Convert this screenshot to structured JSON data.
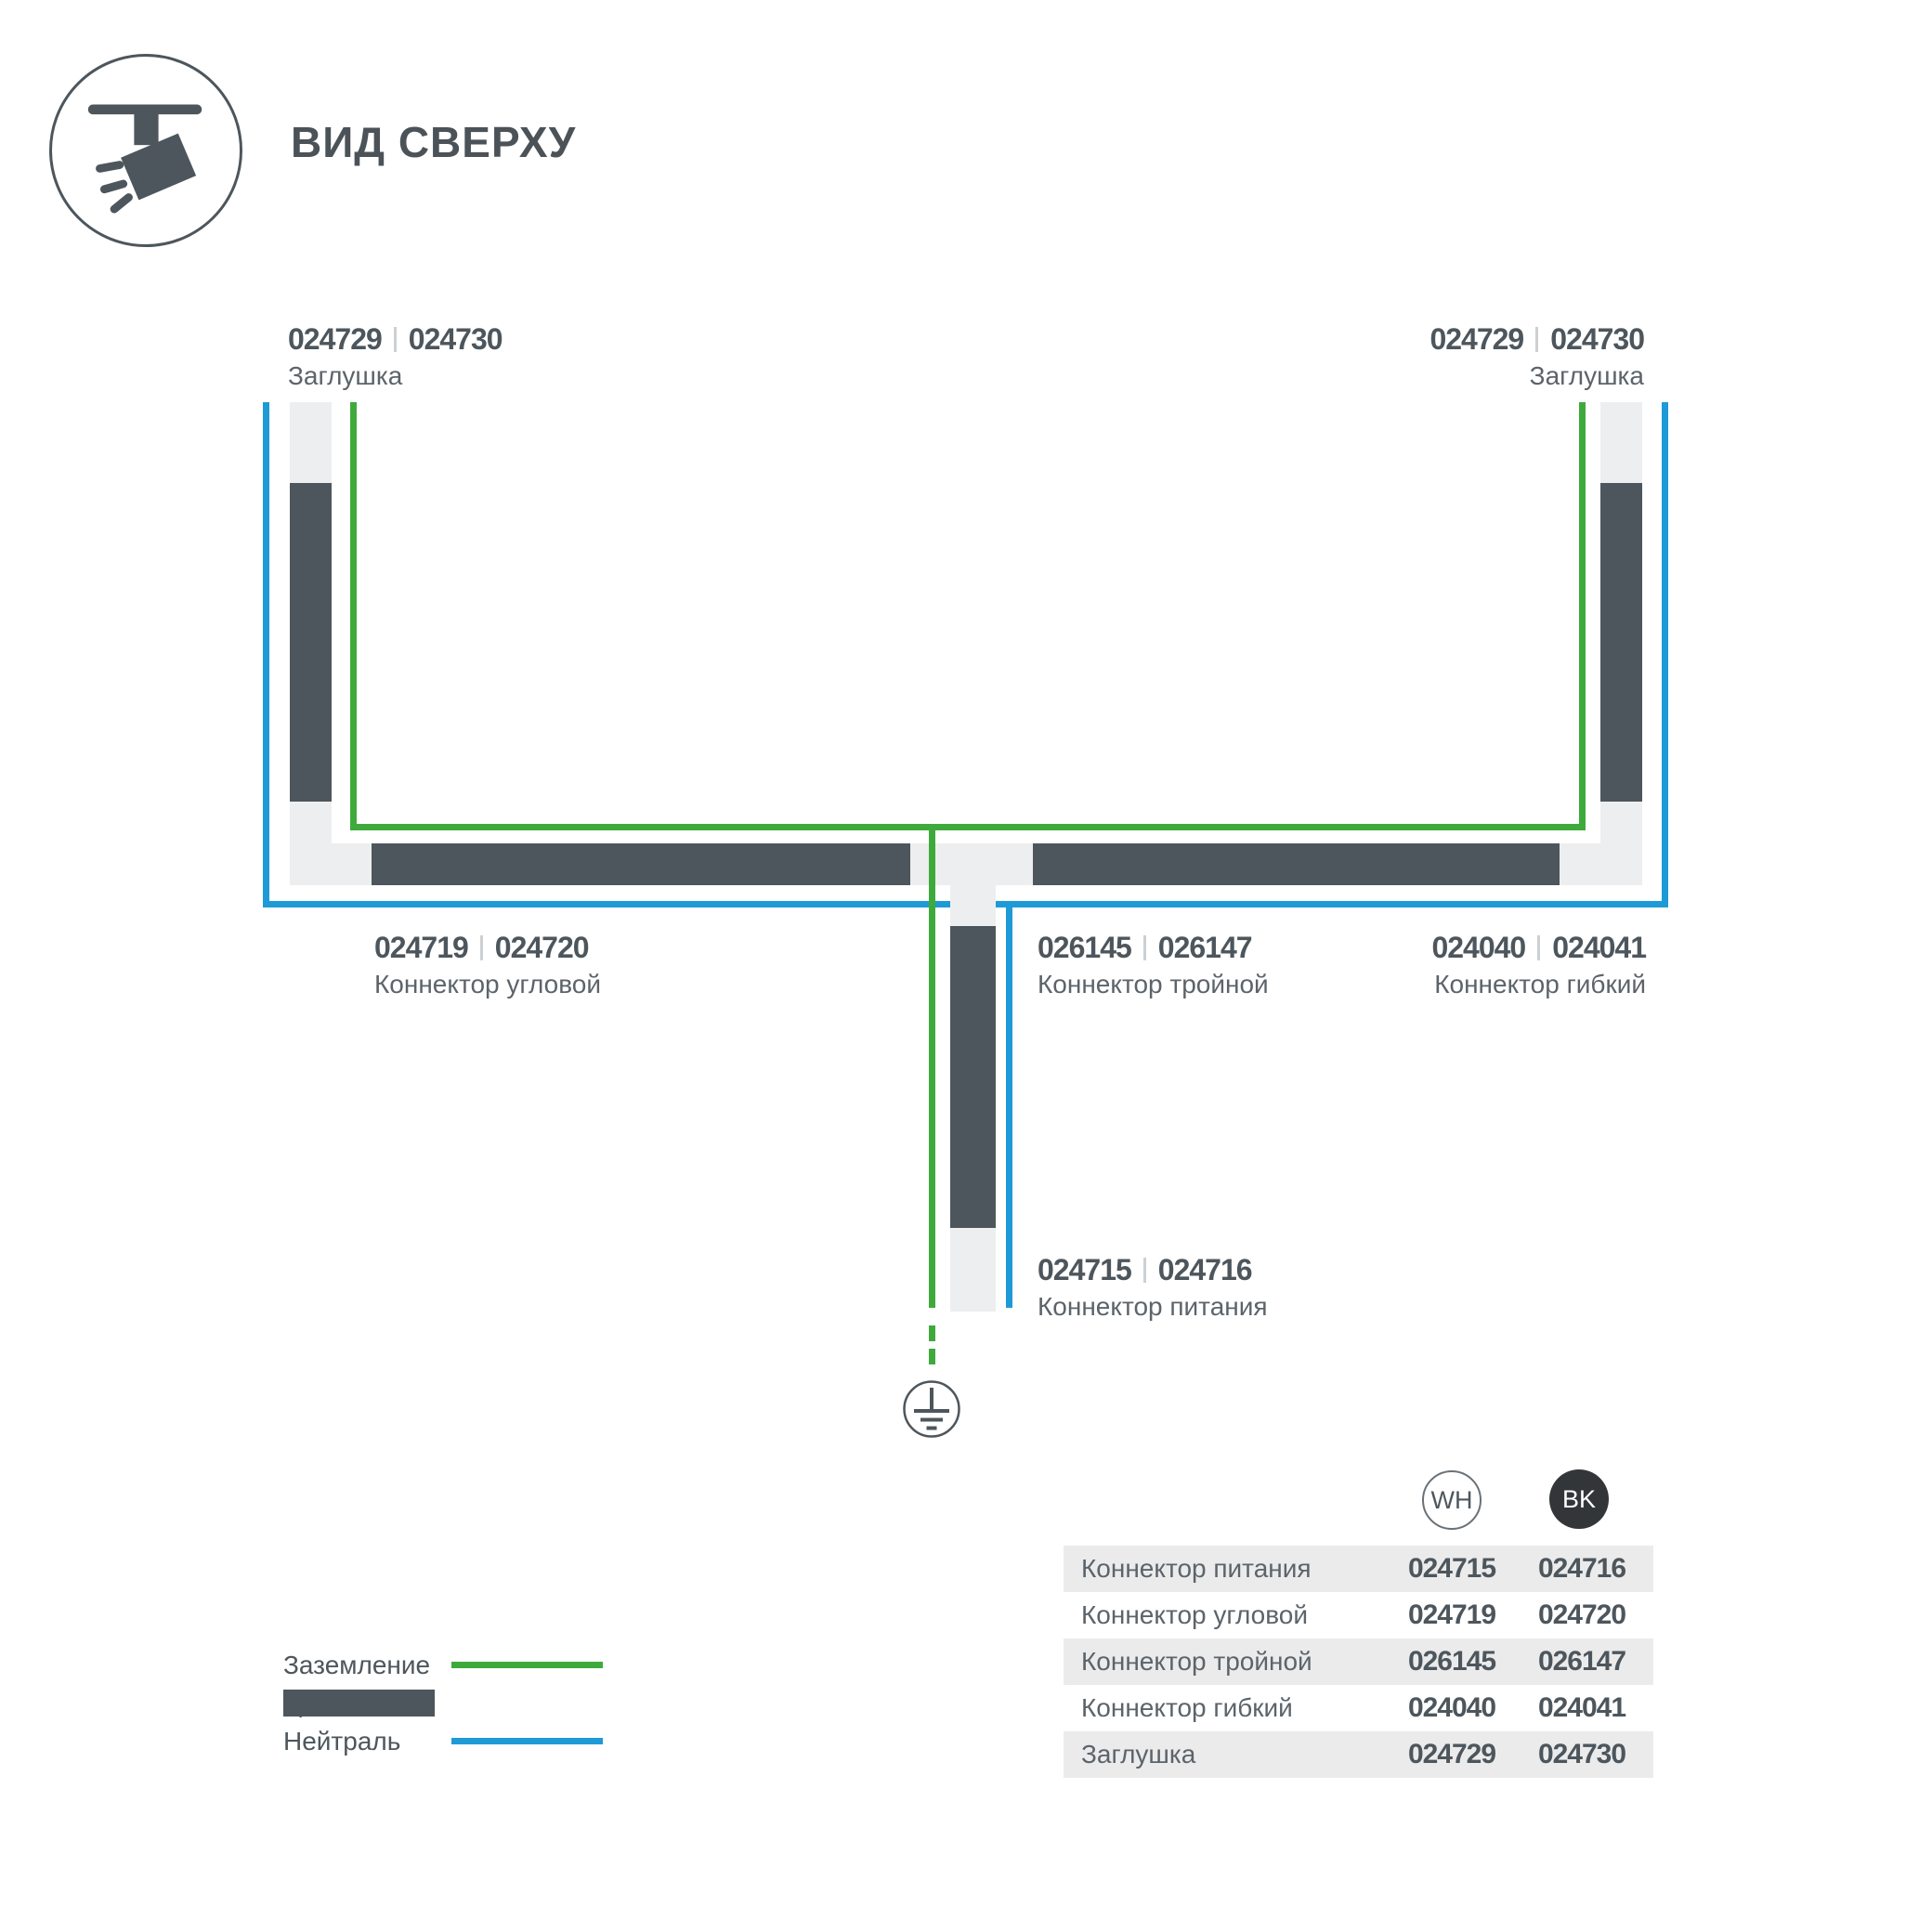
{
  "title": "ВИД СВЕРХУ",
  "colors": {
    "track": "#4d565c",
    "ground_wire": "#3faa3c",
    "neutral_wire": "#1e9ad6",
    "connector": "#edeeef",
    "bk_badge": "#323639"
  },
  "parts": {
    "cap_left": {
      "code_wh": "024729",
      "code_bk": "024730",
      "name": "Заглушка"
    },
    "cap_right": {
      "code_wh": "024729",
      "code_bk": "024730",
      "name": "Заглушка"
    },
    "corner": {
      "code_wh": "024719",
      "code_bk": "024720",
      "name": "Коннектор угловой"
    },
    "triple": {
      "code_wh": "026145",
      "code_bk": "026147",
      "name": "Коннектор тройной"
    },
    "flex": {
      "code_wh": "024040",
      "code_bk": "024041",
      "name": "Коннектор гибкий"
    },
    "power": {
      "code_wh": "024715",
      "code_bk": "024716",
      "name": "Коннектор питания"
    }
  },
  "legend": {
    "ground_label": "Заземление",
    "track_label": "Трек",
    "neutral_label": "Нейтраль"
  },
  "table": {
    "col_wh": "WH",
    "col_bk": "BK",
    "rows": [
      {
        "label": "Коннектор питания",
        "wh": "024715",
        "bk": "024716"
      },
      {
        "label": "Коннектор угловой",
        "wh": "024719",
        "bk": "024720"
      },
      {
        "label": "Коннектор тройной",
        "wh": "026145",
        "bk": "026147"
      },
      {
        "label": "Коннектор гибкий",
        "wh": "024040",
        "bk": "024041"
      },
      {
        "label": "Заглушка",
        "wh": "024729",
        "bk": "024730"
      }
    ]
  }
}
